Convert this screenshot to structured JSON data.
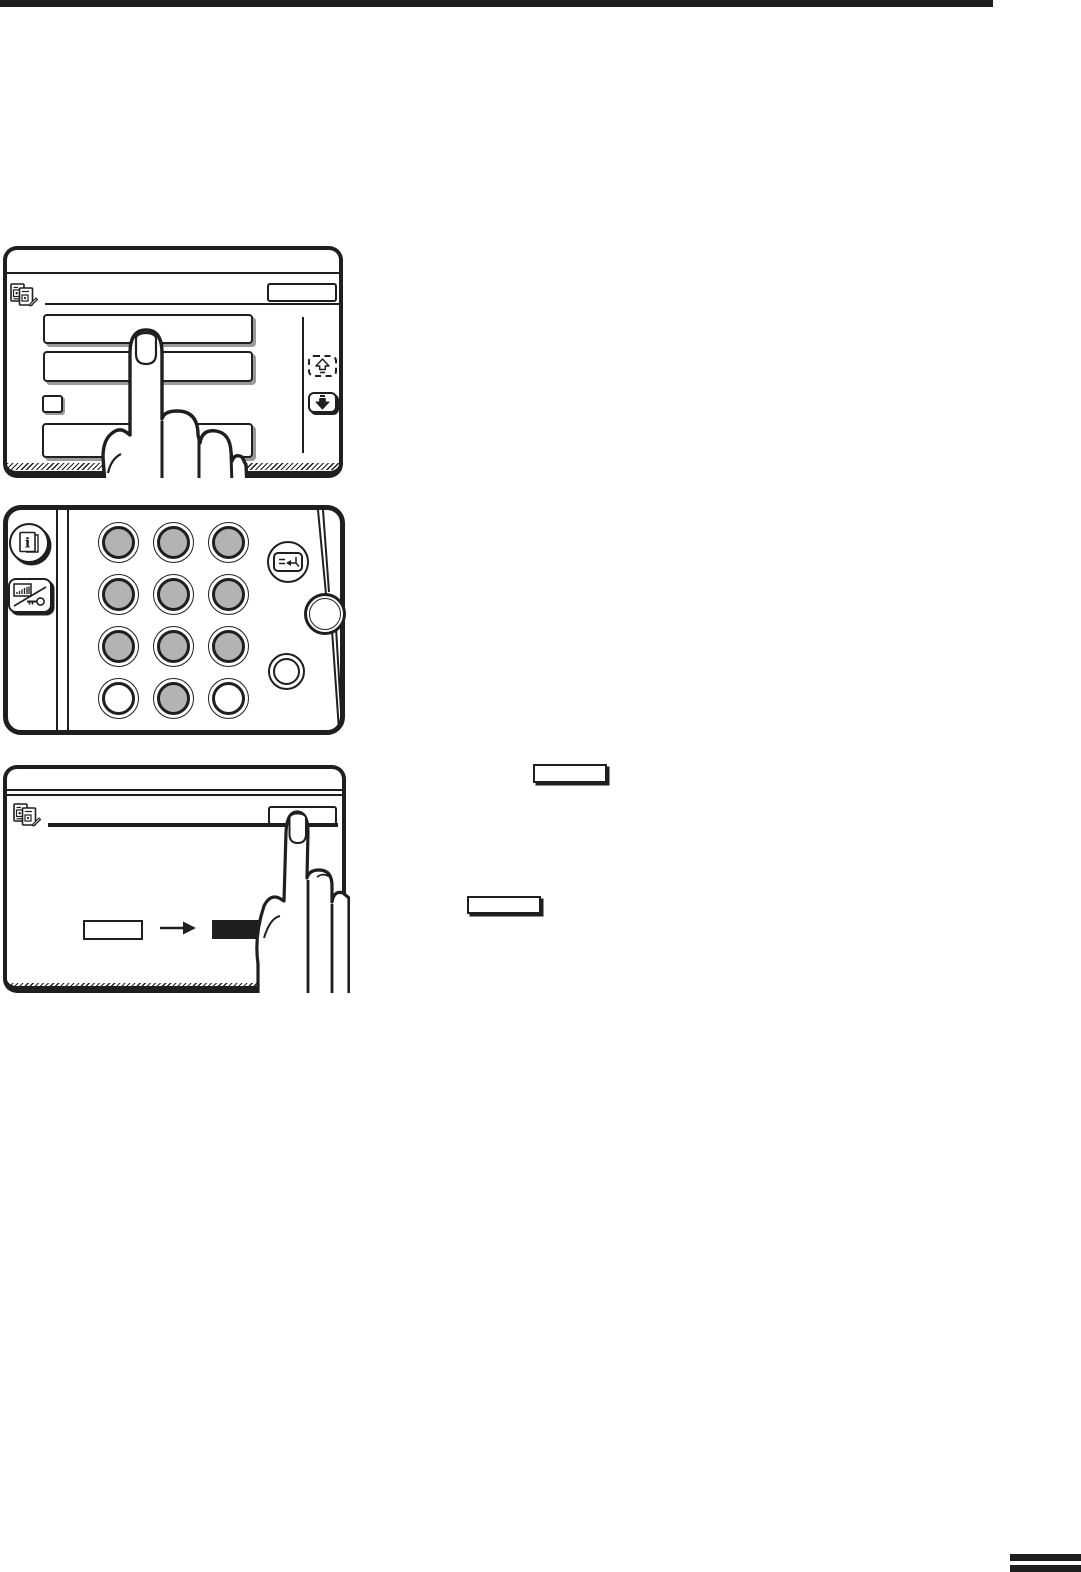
{
  "page": {
    "width": 1081,
    "height": 1572,
    "background": "#ffffff",
    "ink": "#1f1f1f",
    "keypad_shade": "#b3b3b3",
    "button_shadow": "#9a9a9a"
  },
  "header_rule": {
    "present": true,
    "side": "top-left"
  },
  "corner_tabs": {
    "bar_count": 2,
    "position": "bottom-right"
  },
  "figure1": {
    "name": "touch-panel-list-selection",
    "corner_icon": "document-copy-icon",
    "header_button_label": "",
    "list_button_count": 3,
    "has_option_checkbox": true,
    "scroll_up_state": "disabled-dashed",
    "scroll_down_state": "enabled-solid",
    "hand": "index-finger-pressing-first-list-button"
  },
  "figure2": {
    "name": "operation-keypad",
    "grid": [
      [
        "shaded",
        "shaded",
        "shaded"
      ],
      [
        "shaded",
        "shaded",
        "shaded"
      ],
      [
        "shaded",
        "shaded",
        "shaded"
      ],
      [
        "plain",
        "shaded",
        "plain"
      ]
    ],
    "left_keys": [
      "information-key",
      "account-counter-key"
    ],
    "right_keys": [
      "enter-key",
      "start-key",
      "clear-key"
    ]
  },
  "figure3": {
    "name": "touch-panel-confirmation",
    "corner_icon": "document-copy-icon",
    "header_button_label": "",
    "transition": {
      "from": "outlined-box",
      "arrow": "right-arrow",
      "to": "filled-box"
    },
    "hand": "index-finger-pressing-header-button"
  },
  "callouts": {
    "key_box_count": 2,
    "labels": [
      "",
      ""
    ]
  }
}
